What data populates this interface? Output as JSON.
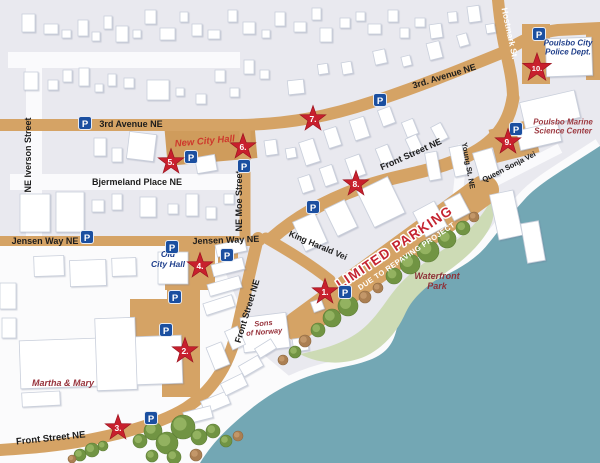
{
  "map": {
    "colors": {
      "land": "#e9e9ef",
      "land_white": "#fbfbfc",
      "street_tan": "#d5a365",
      "water": "#73a7b4",
      "park_green": "#cddbb5",
      "star_red": "#c8202d",
      "parking_blue": "#1b4fa0",
      "street_text": "#1c1c1c",
      "blue_place_text": "#203f8a",
      "red_place_text": "#97333c"
    },
    "street_labels": [
      {
        "text": "3rd Avenue NE",
        "x": 131,
        "y": 127,
        "r": 0,
        "fs": 9,
        "fill": "#1c1c1c"
      },
      {
        "text": "3rd. Avenue NE",
        "x": 445,
        "y": 79,
        "r": -17,
        "fs": 9,
        "fill": "#1c1c1c"
      },
      {
        "text": "NE Iverson Street",
        "x": 31,
        "y": 155,
        "r": -90,
        "fs": 9,
        "fill": "#1c1c1c"
      },
      {
        "text": "Bjermeland Place NE",
        "x": 137,
        "y": 185,
        "r": 0,
        "fs": 9,
        "fill": "#1c1c1c"
      },
      {
        "text": "NE Moe Street",
        "x": 242,
        "y": 201,
        "r": -90,
        "fs": 9,
        "fill": "#1c1c1c"
      },
      {
        "text": "Front Street NE",
        "x": 412,
        "y": 157,
        "r": -24,
        "fs": 9,
        "fill": "#1c1c1c"
      },
      {
        "text": "Front Street NE",
        "x": 250,
        "y": 312,
        "r": -73,
        "fs": 9,
        "fill": "#1c1c1c"
      },
      {
        "text": "Front Street NE",
        "x": 51,
        "y": 441,
        "r": -6,
        "fs": 9.5,
        "fill": "#1c1c1c"
      },
      {
        "text": "Jensen Way NE",
        "x": 45,
        "y": 244,
        "r": 0,
        "fs": 9,
        "fill": "#1c1c1c"
      },
      {
        "text": "Jensen Way NE",
        "x": 226,
        "y": 243,
        "r": -2,
        "fs": 9,
        "fill": "#1c1c1c"
      },
      {
        "text": "King Harald Vei",
        "x": 317,
        "y": 248,
        "r": 23,
        "fs": 8.5,
        "fill": "#1c1c1c"
      },
      {
        "text": "Hostmark St.",
        "x": 507,
        "y": 34,
        "r": 78,
        "fs": 8.5,
        "fill": "#ffffff"
      },
      {
        "text": "Young St. NE",
        "x": 466,
        "y": 166,
        "r": 80,
        "fs": 7.5,
        "fill": "#1c1c1c"
      },
      {
        "text": "Queen Sonja Vei",
        "x": 510,
        "y": 169,
        "r": -27,
        "fs": 7.5,
        "fill": "#1c1c1c"
      }
    ],
    "place_labels": [
      {
        "name": "new-city-hall",
        "lines": [
          "New City Hall"
        ],
        "x": 205,
        "y": 144,
        "r": -5,
        "fs": 9.5,
        "fill": "#ce382c"
      },
      {
        "name": "old-city-hall",
        "lines": [
          "Old",
          "City Hall"
        ],
        "x": 168,
        "y": 262,
        "r": 0,
        "fs": 8.5,
        "fill": "#1f3f8c"
      },
      {
        "name": "poulsbo-city-police",
        "lines": [
          "Poulsbo City",
          "Police Dept."
        ],
        "x": 568,
        "y": 50,
        "r": 0,
        "fs": 8,
        "fill": "#203f8a"
      },
      {
        "name": "marine-science-center",
        "lines": [
          "Poulsbo Marine",
          "Science Center"
        ],
        "x": 563,
        "y": 129,
        "r": 0,
        "fs": 8,
        "fill": "#9c3940"
      },
      {
        "name": "waterfront-park",
        "lines": [
          "Waterfront",
          "Park"
        ],
        "x": 437,
        "y": 284,
        "r": 0,
        "fs": 9,
        "fill": "#8e333a"
      },
      {
        "name": "martha-and-mary",
        "lines": [
          "Martha & Mary"
        ],
        "x": 63,
        "y": 386,
        "r": 0,
        "fs": 9,
        "fill": "#97333c"
      },
      {
        "name": "sons-of-norway",
        "lines": [
          "Sons",
          "of Norway"
        ],
        "x": 264,
        "y": 330,
        "r": -5,
        "fs": 7.5,
        "fill": "#97333c"
      }
    ],
    "warning": {
      "line1": "LIMITED PARKING",
      "line2": "DUE TO REPAVING PROJECT",
      "x": 397,
      "y": 251,
      "r": -34,
      "color1": "#c42430",
      "color2": "#ffffff",
      "fs1": 13.5,
      "fs2": 7.5
    },
    "stars": [
      {
        "label": "1.",
        "x": 325,
        "y": 292
      },
      {
        "label": "2.",
        "x": 185,
        "y": 351
      },
      {
        "label": "3.",
        "x": 118,
        "y": 428
      },
      {
        "label": "4.",
        "x": 200,
        "y": 266
      },
      {
        "label": "5.",
        "x": 171,
        "y": 162
      },
      {
        "label": "6.",
        "x": 243,
        "y": 147
      },
      {
        "label": "7.",
        "x": 313,
        "y": 119
      },
      {
        "label": "8.",
        "x": 356,
        "y": 184
      },
      {
        "label": "9.",
        "x": 508,
        "y": 142
      },
      {
        "label": "10.",
        "x": 537,
        "y": 68
      }
    ],
    "parking_icon_letter": "P",
    "parking_icons": [
      {
        "x": 85,
        "y": 123
      },
      {
        "x": 380,
        "y": 100
      },
      {
        "x": 539,
        "y": 34
      },
      {
        "x": 516,
        "y": 129
      },
      {
        "x": 191,
        "y": 157
      },
      {
        "x": 244,
        "y": 166
      },
      {
        "x": 313,
        "y": 207
      },
      {
        "x": 87,
        "y": 237
      },
      {
        "x": 172,
        "y": 247
      },
      {
        "x": 227,
        "y": 255
      },
      {
        "x": 175,
        "y": 297
      },
      {
        "x": 166,
        "y": 330
      },
      {
        "x": 151,
        "y": 418
      },
      {
        "x": 345,
        "y": 292
      }
    ]
  }
}
